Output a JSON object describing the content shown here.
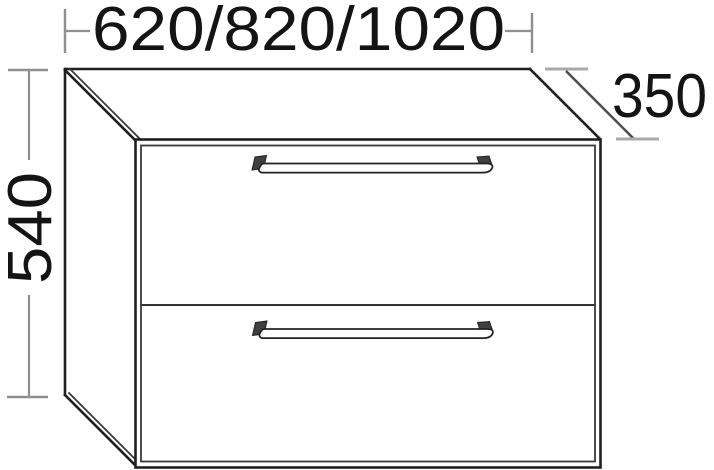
{
  "drawing": {
    "kind": "furniture-technical-line-drawing",
    "object": "two-drawer cabinet, perspective view",
    "drawer_count": 2,
    "labels": {
      "width": "620/820/1020",
      "height": "540",
      "depth": "350"
    },
    "colors": {
      "background": "#ffffff",
      "outline": "#1f1f1f",
      "inner_line": "#3a3a3a",
      "dimension_line": "#8f8f8f",
      "dimension_tick": "#a9a9a9",
      "depth_dimension_line": "#4a4a4a",
      "text": "#141414"
    }
  }
}
